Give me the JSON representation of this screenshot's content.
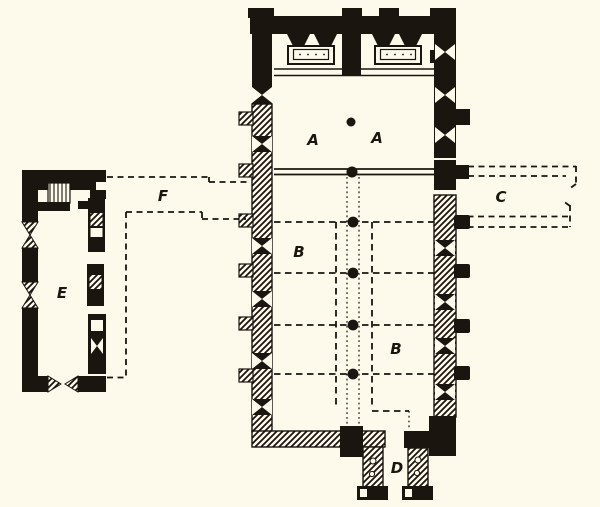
{
  "labels": {
    "area_a_left": "A",
    "area_a_right": "A",
    "area_b_upper": "B",
    "area_b_lower": "B",
    "area_c": "C",
    "area_d": "D",
    "area_e": "E",
    "area_f": "F"
  },
  "colors": {
    "ink": "#1b1510",
    "paper": "#fdf9eb"
  }
}
